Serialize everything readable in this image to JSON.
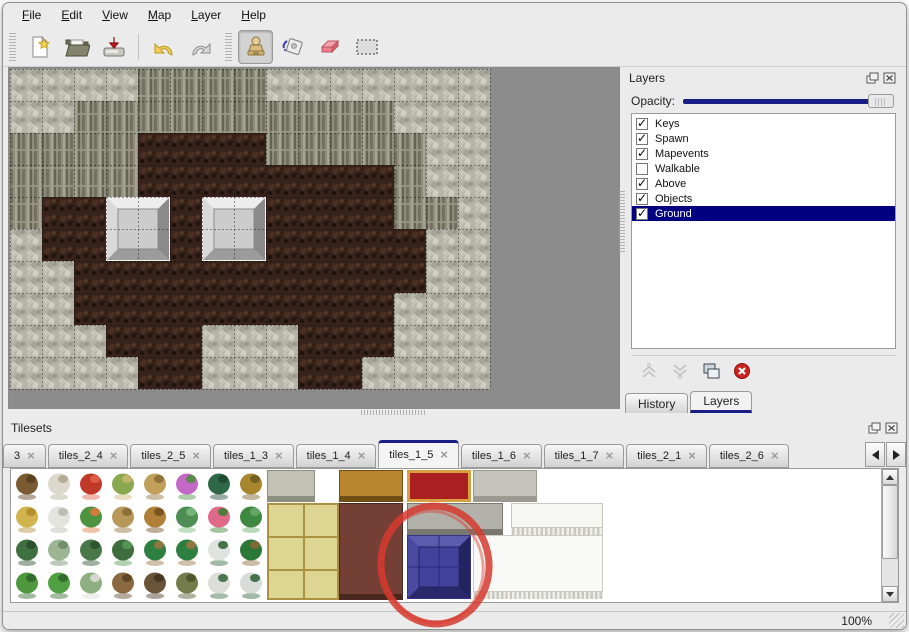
{
  "menu": {
    "items": [
      "File",
      "Edit",
      "View",
      "Map",
      "Layer",
      "Help"
    ]
  },
  "toolbar": {
    "buttons": [
      {
        "type": "grip"
      },
      {
        "type": "button",
        "name": "new-file",
        "selected": false
      },
      {
        "type": "button",
        "name": "open-file",
        "selected": false
      },
      {
        "type": "button",
        "name": "save-file",
        "selected": false
      },
      {
        "type": "sep"
      },
      {
        "type": "button",
        "name": "undo",
        "selected": false
      },
      {
        "type": "button",
        "name": "redo",
        "selected": false
      },
      {
        "type": "grip"
      },
      {
        "type": "button",
        "name": "stamp-tool",
        "selected": true
      },
      {
        "type": "button",
        "name": "fill-tool",
        "selected": false
      },
      {
        "type": "button",
        "name": "eraser-tool",
        "selected": false
      },
      {
        "type": "button",
        "name": "select-tool",
        "selected": false
      }
    ]
  },
  "layers_panel": {
    "title": "Layers",
    "opacity_label": "Opacity:",
    "opacity_value_pct": 100,
    "layers": [
      {
        "name": "Keys",
        "checked": true,
        "selected": false
      },
      {
        "name": "Spawn",
        "checked": true,
        "selected": false
      },
      {
        "name": "Mapevents",
        "checked": true,
        "selected": false
      },
      {
        "name": "Walkable",
        "checked": false,
        "selected": false
      },
      {
        "name": "Above",
        "checked": true,
        "selected": false
      },
      {
        "name": "Objects",
        "checked": true,
        "selected": false
      },
      {
        "name": "Ground",
        "checked": true,
        "selected": true
      }
    ],
    "actions": [
      {
        "name": "raise-layer",
        "enabled": false
      },
      {
        "name": "lower-layer",
        "enabled": false
      },
      {
        "name": "duplicate-layer",
        "enabled": true
      },
      {
        "name": "delete-layer",
        "enabled": true
      }
    ],
    "tabs": [
      {
        "label": "History",
        "active": false
      },
      {
        "label": "Layers",
        "active": true
      }
    ]
  },
  "tilesets_panel": {
    "title": "Tilesets",
    "tabs": [
      {
        "label": "3",
        "active": false
      },
      {
        "label": "tiles_2_4",
        "active": false
      },
      {
        "label": "tiles_2_5",
        "active": false
      },
      {
        "label": "tiles_1_3",
        "active": false
      },
      {
        "label": "tiles_1_4",
        "active": false
      },
      {
        "label": "tiles_1_5",
        "active": true
      },
      {
        "label": "tiles_1_6",
        "active": false
      },
      {
        "label": "tiles_1_7",
        "active": false
      },
      {
        "label": "tiles_2_1",
        "active": false
      },
      {
        "label": "tiles_2_6",
        "active": false
      }
    ]
  },
  "statusbar": {
    "zoom": "100%"
  },
  "colors": {
    "accent_navy": "#191d86",
    "selection_navy": "#000080",
    "annotation_red": "#d63a2e",
    "canvas_gray": "#8c8c8c"
  },
  "map": {
    "tile_size": 32,
    "cols": 15,
    "rows": 10,
    "legend": {
      "W": "rock-wall",
      "C": "cliff-face",
      "F": "dirt-floor"
    },
    "grid": [
      "WWWWCCCCWWWWWWW",
      "WWCCCCCCCCCCWWW",
      "CCCCFFFFCCCCCWW",
      "CCCCFFFFFFFFCWW",
      "CFFFFFFFFFFFCCW",
      "WFFFFFFFFFFFFWW",
      "WWFFFFFFFFFFFWW",
      "WWFFFFFFFFFFWWW",
      "WWWFFFWWWFFFWWW",
      "WWWWFFWWWFFWWWW"
    ],
    "blocks": [
      {
        "col": 3,
        "row": 4
      },
      {
        "col": 6,
        "row": 4
      }
    ]
  },
  "tileset": {
    "nature_tiles": [
      [
        [
          "#7a5a32",
          "#5a3e1e"
        ],
        [
          "#dcd8cc",
          "#b0a890"
        ],
        [
          "#c03828",
          "#e06048"
        ],
        [
          "#8aa84e",
          "#c8b470"
        ],
        [
          "#c0a05a",
          "#8a6c36"
        ],
        [
          "#c468c8",
          "#4e8e3e"
        ],
        [
          "#2e6848",
          "#1e4830"
        ],
        [
          "#a8862e",
          "#6e5a20"
        ]
      ],
      [
        [
          "#d2b44e",
          "#b08c2e"
        ],
        [
          "#e4e4de",
          "#b8b8ae"
        ],
        [
          "#4e9440",
          "#e07838"
        ],
        [
          "#b89858",
          "#8a6c34"
        ],
        [
          "#b08038",
          "#744e1e"
        ],
        [
          "#4e8e52",
          "#78b87c"
        ],
        [
          "#e06888",
          "#3e7e34"
        ],
        [
          "#3e8840",
          "#68a868"
        ]
      ],
      [
        [
          "#3e7040",
          "#284e2a"
        ],
        [
          "#9cb694",
          "#6e8a66"
        ],
        [
          "#487848",
          "#2e522e"
        ],
        [
          "#3e6e3e",
          "#579957"
        ],
        [
          "#2e8040",
          "#9a7440"
        ],
        [
          "#2e8040",
          "#9a7440"
        ],
        [
          "#e0e4e0",
          "#34663c"
        ],
        [
          "#2a7838",
          "#8a6838"
        ]
      ],
      [
        [
          "#4e9840",
          "#2e6828"
        ],
        [
          "#52a044",
          "#2e6828"
        ],
        [
          "#8eb080",
          "#dcdcd4"
        ],
        [
          "#8a6840",
          "#5a4224"
        ],
        [
          "#6a5438",
          "#443320"
        ],
        [
          "#747c4a",
          "#4a5228"
        ],
        [
          "#dcdcd8",
          "#3a6a42"
        ],
        [
          "#d8dcd8",
          "#34643c"
        ]
      ]
    ],
    "furniture_tiles": [
      {
        "name": "stone-cobble",
        "x": 256,
        "y": 1,
        "w": 48,
        "h": 32,
        "kind": "flat",
        "c1": "#c2c2b4",
        "c2": "#8e8e80"
      },
      {
        "name": "straw-mats",
        "x": 256,
        "y": 34,
        "w": 72,
        "h": 97,
        "kind": "mat",
        "c1": "#ded593",
        "c2": "#ab9240"
      },
      {
        "name": "gold-counter",
        "x": 328,
        "y": 1,
        "w": 64,
        "h": 32,
        "kind": "flat",
        "c1": "#b8862c",
        "c2": "#6e4e14"
      },
      {
        "name": "red-carpet",
        "x": 396,
        "y": 1,
        "w": 64,
        "h": 32,
        "kind": "carpet",
        "c1": "#aa2020",
        "c2": "#d8a040"
      },
      {
        "name": "gray-slab",
        "x": 462,
        "y": 1,
        "w": 64,
        "h": 32,
        "kind": "flat",
        "c1": "#c4c4bc",
        "c2": "#9a9a90"
      },
      {
        "name": "brown-table",
        "x": 328,
        "y": 34,
        "w": 64,
        "h": 97,
        "kind": "flat",
        "c1": "#744036",
        "c2": "#4a2820"
      },
      {
        "name": "stone-stairs",
        "x": 396,
        "y": 34,
        "w": 96,
        "h": 32,
        "kind": "flat",
        "c1": "#b2b2aa",
        "c2": "#787870"
      },
      {
        "name": "white-cloth-top",
        "x": 500,
        "y": 34,
        "w": 92,
        "h": 32,
        "kind": "fringe",
        "c1": "#f6f6f2",
        "c2": "#c8c8c0"
      },
      {
        "name": "white-cloth-big",
        "x": 462,
        "y": 66,
        "w": 130,
        "h": 64,
        "kind": "fringe",
        "c1": "#f8f8f6",
        "c2": "#ccccc4"
      },
      {
        "name": "blue-block-selected",
        "x": 396,
        "y": 66,
        "w": 64,
        "h": 64,
        "kind": "bevel-blue"
      }
    ],
    "annotation": {
      "shape": "ellipse",
      "cx": 424,
      "cy": 97,
      "rx": 54,
      "ry": 59,
      "color": "#d63a2e"
    }
  }
}
